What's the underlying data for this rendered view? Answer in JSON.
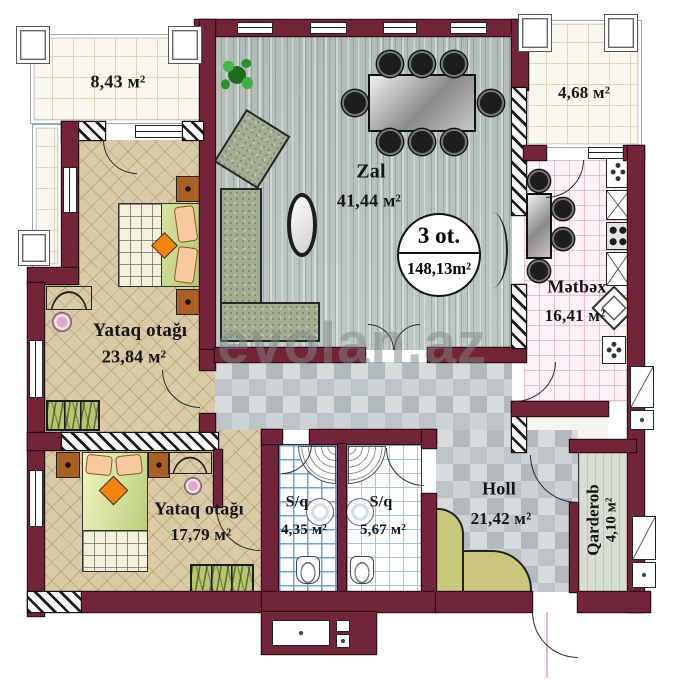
{
  "watermark": "evolan.az",
  "badge": {
    "rooms_count": "3 ot.",
    "total_area": "148,13m²"
  },
  "rooms": {
    "terrace_left": {
      "area": "8,43 м²"
    },
    "terrace_right": {
      "area": "4,68 м²"
    },
    "living": {
      "name": "Zal",
      "area": "41,44 м²"
    },
    "kitchen": {
      "name": "Mətbəx",
      "area": "16,41 м²"
    },
    "bedroom_main": {
      "name": "Yataq otağı",
      "area": "23,84 м²"
    },
    "bedroom_second": {
      "name": "Yataq otağı",
      "area": "17,79 м²"
    },
    "bathroom_small": {
      "name": "S/q",
      "area": "4,35 м²"
    },
    "bathroom_large": {
      "name": "S/q",
      "area": "5,67 м²"
    },
    "hall": {
      "name": "Holl",
      "area": "21,42 м²"
    },
    "wardrobe_room": {
      "name": "Qarderob",
      "area": "4,10 м²"
    }
  },
  "colors": {
    "wall": "#74243a",
    "living_floor": "#b9c4be",
    "bedroom_floor": "#d9cba6",
    "hall_floor": "#c3c9cb",
    "kitchen_floor": "#fdf3f7",
    "bath_grid": "#5c9ad6",
    "balcony_floor": "#faf8ee",
    "wardrobe_floor": "#d9ded2",
    "furniture_olive": "#b9c573",
    "accent_orange": "#f5820c"
  }
}
